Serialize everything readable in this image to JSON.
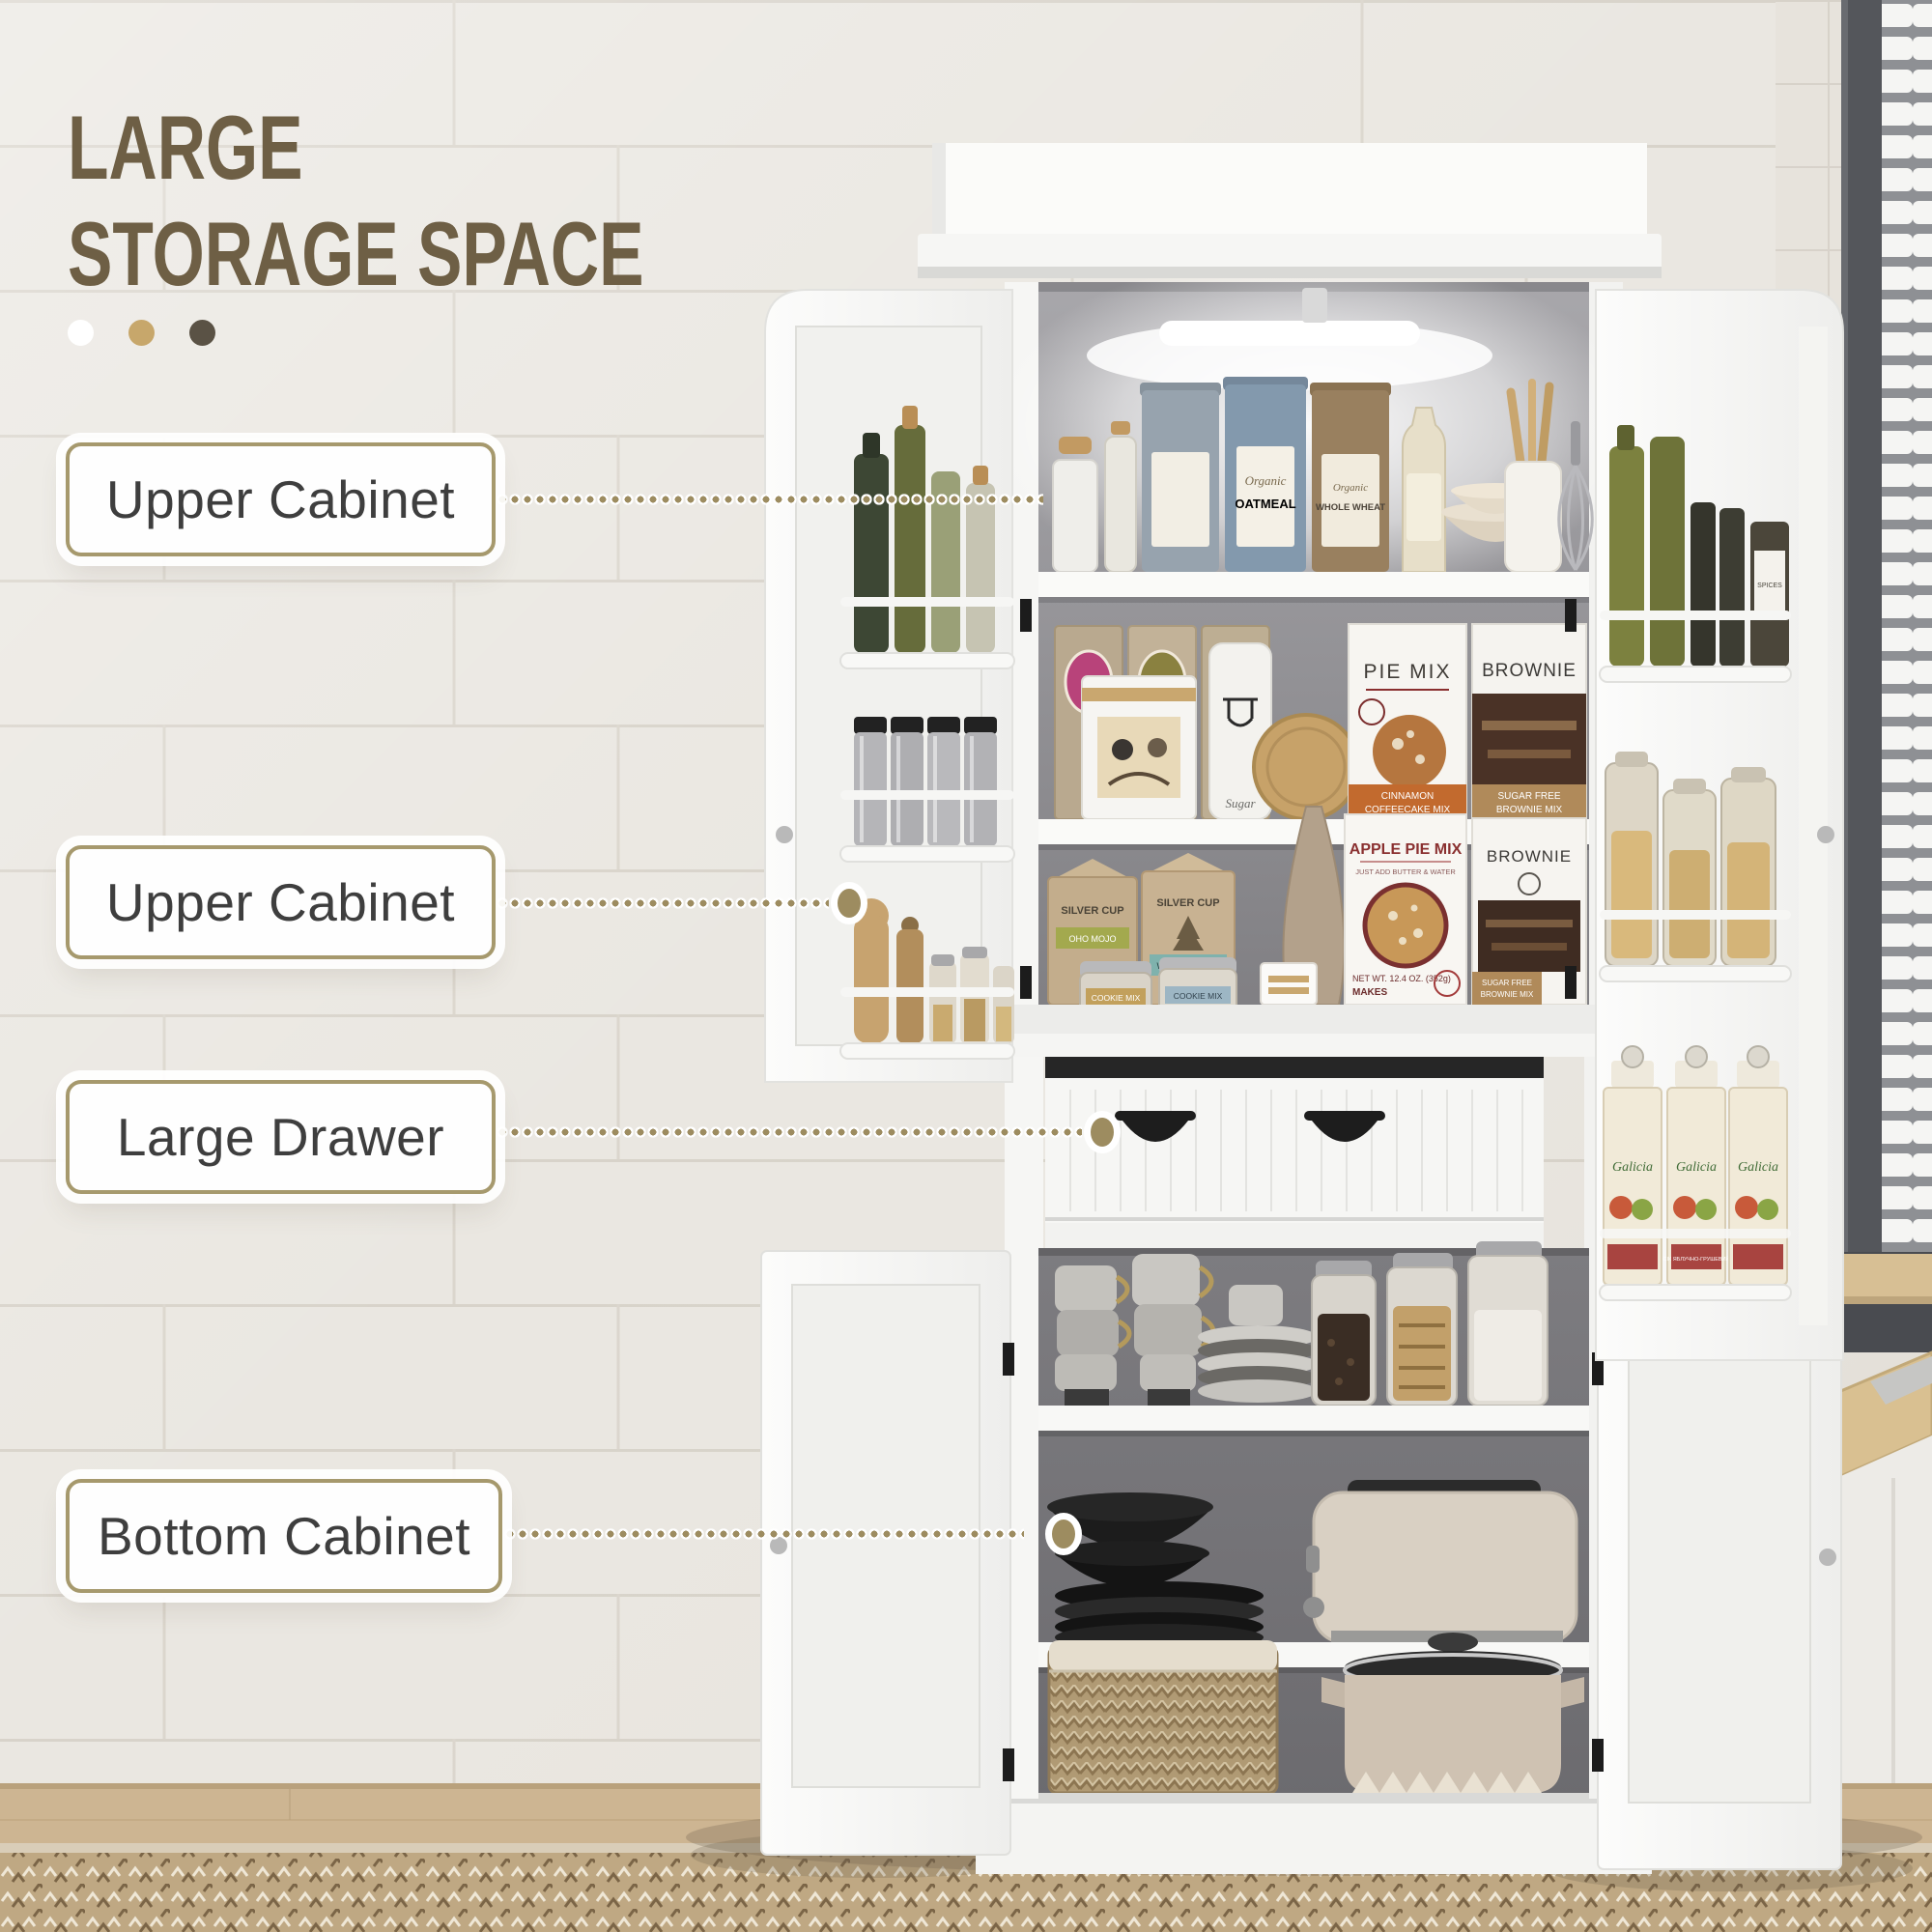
{
  "title": {
    "line1": "LARGE",
    "line2": "STORAGE SPACE"
  },
  "callouts": [
    {
      "label": "Upper Cabinet"
    },
    {
      "label": "Upper Cabinet"
    },
    {
      "label": "Large Drawer"
    },
    {
      "label": "Bottom Cabinet"
    }
  ],
  "products": {
    "organic": "Organic",
    "oatmeal": "OATMEAL",
    "whole_wheat": "WHOLE WHEAT",
    "pie_mix": "PIE MIX",
    "cinnamon_line1": "CINNAMON",
    "cinnamon_line2": "COFFEECAKE MIX",
    "brownie": "BROWNIE",
    "sugarfree_line1": "SUGAR FREE",
    "sugarfree_line2": "BROWNIE MIX",
    "silver_cup": "SILVER CUP",
    "oho_mojo": "OHO MOJO",
    "wonderland": "WONDERLAND",
    "cookie_mix": "COOKIE MIX",
    "apple_pie_mix": "APPLE PIE MIX",
    "just_add": "JUST ADD BUTTER & WATER",
    "net_wt": "NET WT. 12.4 OZ. (352g)",
    "makes": "MAKES",
    "sugar": "Sugar",
    "spices": "SPICES",
    "galicia": "Galicia",
    "galicia_sub": "СІК ЯБЛУЧНО-ГРУШЕВИЙ"
  },
  "colors": {
    "title_text": "#6e5f45",
    "callout_border": "#a6996d",
    "leader_dots": "#9d8c60",
    "accent_dot_1": "#ffffff",
    "accent_dot_2": "#c7a76b",
    "accent_dot_3": "#5a5245"
  }
}
